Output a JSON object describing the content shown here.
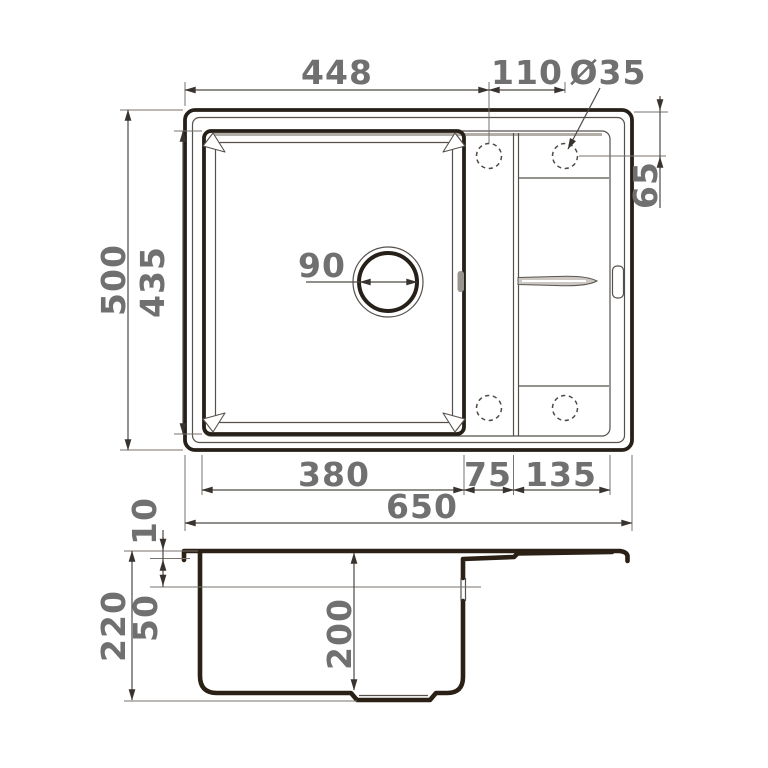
{
  "dimensions": {
    "top_view": {
      "left_edge_to_tap_center": "448",
      "tap_hole_spacing": "110",
      "tap_hole_diameter": "Ø35",
      "overall_depth": "500",
      "bowl_length": "435",
      "tap_center_from_back_edge": "65",
      "drain_diameter": "90",
      "bowl_width": "380",
      "bowl_to_wing_gap": "75",
      "wing_width": "135",
      "overall_width": "650"
    },
    "section_view": {
      "rim_thickness": "10",
      "ledge_depth": "50",
      "overall_height": "220",
      "bowl_depth": "200"
    }
  },
  "colors": {
    "outline_top_view": "#262019",
    "outline_section": "#2b2015",
    "dimension_text": "#707070",
    "dimension_line": "#4e4a46",
    "deck_shadow": "#b3ada7",
    "background": "#ffffff"
  }
}
